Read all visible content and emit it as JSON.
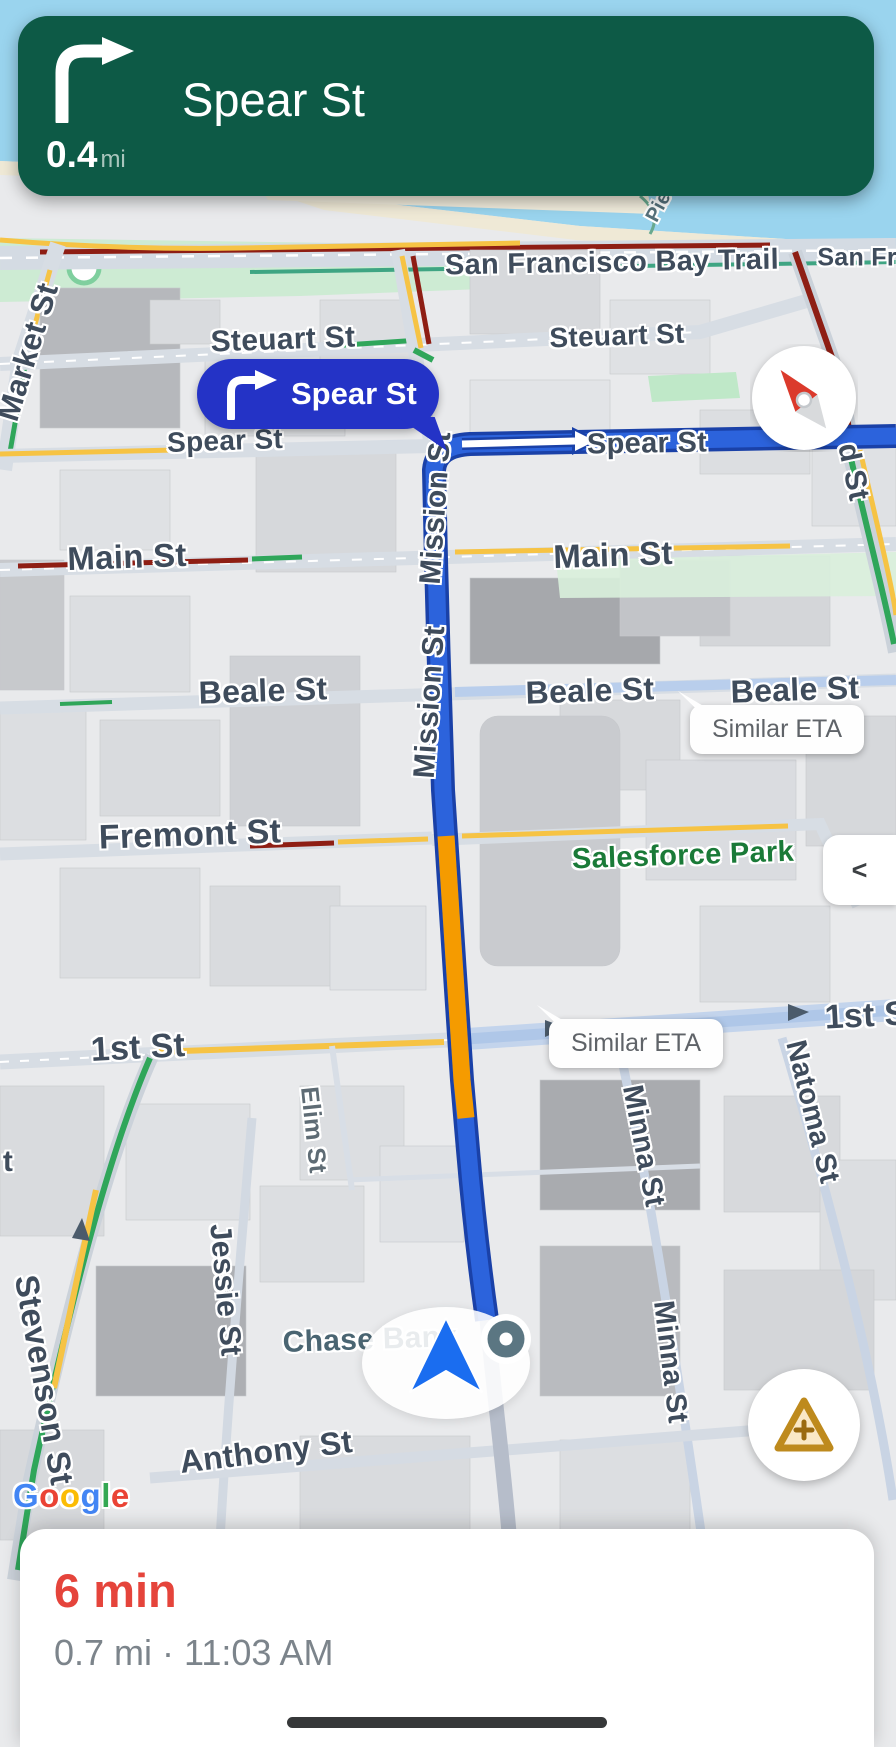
{
  "banner": {
    "instruction": "Spear St",
    "distance_value": "0.4",
    "distance_unit": "mi",
    "maneuver": "turn-right",
    "bg_color": "#0D5A46"
  },
  "callout": {
    "label": "Spear St",
    "bg_color": "#2433C6"
  },
  "tooltips": {
    "eta1": "Similar ETA",
    "eta2": "Similar ETA"
  },
  "controls": {
    "collapse_glyph": "<"
  },
  "eta_card": {
    "duration": "6 min",
    "details": "0.7 mi · 11:03 AM",
    "duration_color": "#E5443B"
  },
  "watermark": {
    "word": "Google",
    "letters": [
      {
        "ch": "G",
        "color": "#4285F4"
      },
      {
        "ch": "o",
        "color": "#EA4335"
      },
      {
        "ch": "o",
        "color": "#FBBC05"
      },
      {
        "ch": "g",
        "color": "#4285F4"
      },
      {
        "ch": "l",
        "color": "#34A853"
      },
      {
        "ch": "e",
        "color": "#EA4335"
      }
    ]
  },
  "colors": {
    "route_blue": "#2C63DC",
    "route_casing": "#1A41A8",
    "traffic_orange": "#F59B00",
    "traffic_yellow": "#F6C344",
    "traffic_green": "#2FA65A",
    "congestion_dark_red": "#8E1E14",
    "water": "#9AD4EE",
    "park_green": "#CDEBD3",
    "street_label": "#3F4C5C",
    "poi_green_label": "#1A7A38"
  },
  "map": {
    "labels": [
      {
        "text": "San Francisco Bay Trail",
        "x": 612,
        "y": 263,
        "rot": -1,
        "size": 29,
        "name": "street-label-sf-bay-trail"
      },
      {
        "text": "San Fran",
        "x": 872,
        "y": 258,
        "rot": 0,
        "size": 25,
        "name": "street-label-san-francisco-clipped"
      },
      {
        "text": "Pie",
        "x": 659,
        "y": 207,
        "rot": -62,
        "size": 20,
        "color": "#55707A",
        "name": "street-label-pier"
      },
      {
        "text": "Steuart St",
        "x": 283,
        "y": 340,
        "rot": -2,
        "size": 30,
        "name": "street-label-steuart-1"
      },
      {
        "text": "Steuart St",
        "x": 617,
        "y": 336,
        "rot": -2,
        "size": 28,
        "name": "street-label-steuart-2"
      },
      {
        "text": "Spear St",
        "x": 225,
        "y": 441,
        "rot": -2,
        "size": 28,
        "name": "street-label-spear-1"
      },
      {
        "text": "Spear St",
        "x": 647,
        "y": 444,
        "rot": -1,
        "size": 29,
        "name": "street-label-spear-2"
      },
      {
        "text": "Main St",
        "x": 127,
        "y": 557,
        "rot": -2,
        "size": 33,
        "name": "street-label-main-1"
      },
      {
        "text": "Main St",
        "x": 613,
        "y": 555,
        "rot": -2,
        "size": 33,
        "name": "street-label-main-2"
      },
      {
        "text": "Beale St",
        "x": 263,
        "y": 691,
        "rot": -2,
        "size": 32,
        "name": "street-label-beale-1"
      },
      {
        "text": "Beale St",
        "x": 590,
        "y": 691,
        "rot": -2,
        "size": 32,
        "name": "street-label-beale-2"
      },
      {
        "text": "Beale St",
        "x": 795,
        "y": 690,
        "rot": -2,
        "size": 32,
        "name": "street-label-beale-3"
      },
      {
        "text": "Fremont St",
        "x": 190,
        "y": 835,
        "rot": -2,
        "size": 34,
        "name": "street-label-fremont"
      },
      {
        "text": "Salesforce Park",
        "x": 683,
        "y": 856,
        "rot": -2,
        "size": 29,
        "color": "#1A7A38",
        "name": "poi-label-salesforce-park"
      },
      {
        "text": "1st St",
        "x": 138,
        "y": 1048,
        "rot": -3,
        "size": 34,
        "name": "street-label-1st-left"
      },
      {
        "text": "1st S",
        "x": 866,
        "y": 1016,
        "rot": -3,
        "size": 34,
        "name": "street-label-1st-right-clipped"
      },
      {
        "text": "Mission St",
        "x": 436,
        "y": 508,
        "rot": -86,
        "size": 30,
        "name": "street-label-mission-1"
      },
      {
        "text": "Mission St",
        "x": 430,
        "y": 702,
        "rot": -86,
        "size": 30,
        "name": "street-label-mission-2"
      },
      {
        "text": "Market St",
        "x": 28,
        "y": 352,
        "rot": -73,
        "size": 31,
        "name": "street-label-market"
      },
      {
        "text": "d St",
        "x": 853,
        "y": 472,
        "rot": 78,
        "size": 30,
        "name": "street-label-d-st-clipped"
      },
      {
        "text": "Natoma St",
        "x": 812,
        "y": 1112,
        "rot": 76,
        "size": 29,
        "name": "street-label-natoma"
      },
      {
        "text": "Minna St",
        "x": 643,
        "y": 1146,
        "rot": 79,
        "size": 29,
        "name": "street-label-minna-1"
      },
      {
        "text": "Minna St",
        "x": 670,
        "y": 1362,
        "rot": 83,
        "size": 29,
        "name": "street-label-minna-2"
      },
      {
        "text": "Elim St",
        "x": 313,
        "y": 1130,
        "rot": 84,
        "size": 25,
        "color": "#5E6B74",
        "name": "street-label-elim"
      },
      {
        "text": "Jessie St",
        "x": 225,
        "y": 1290,
        "rot": 85,
        "size": 30,
        "name": "street-label-jessie"
      },
      {
        "text": "Stevenson St",
        "x": 44,
        "y": 1380,
        "rot": 80,
        "size": 33,
        "name": "street-label-stevenson"
      },
      {
        "text": "t",
        "x": 8,
        "y": 1162,
        "rot": 0,
        "size": 30,
        "name": "street-label-partial-t"
      },
      {
        "text": "Anthony St",
        "x": 266,
        "y": 1452,
        "rot": -7,
        "size": 32,
        "name": "street-label-anthony"
      },
      {
        "text": "Chase Bank",
        "x": 370,
        "y": 1340,
        "rot": -2,
        "size": 30,
        "color": "#4A6572",
        "name": "poi-label-chase-bank"
      }
    ]
  }
}
